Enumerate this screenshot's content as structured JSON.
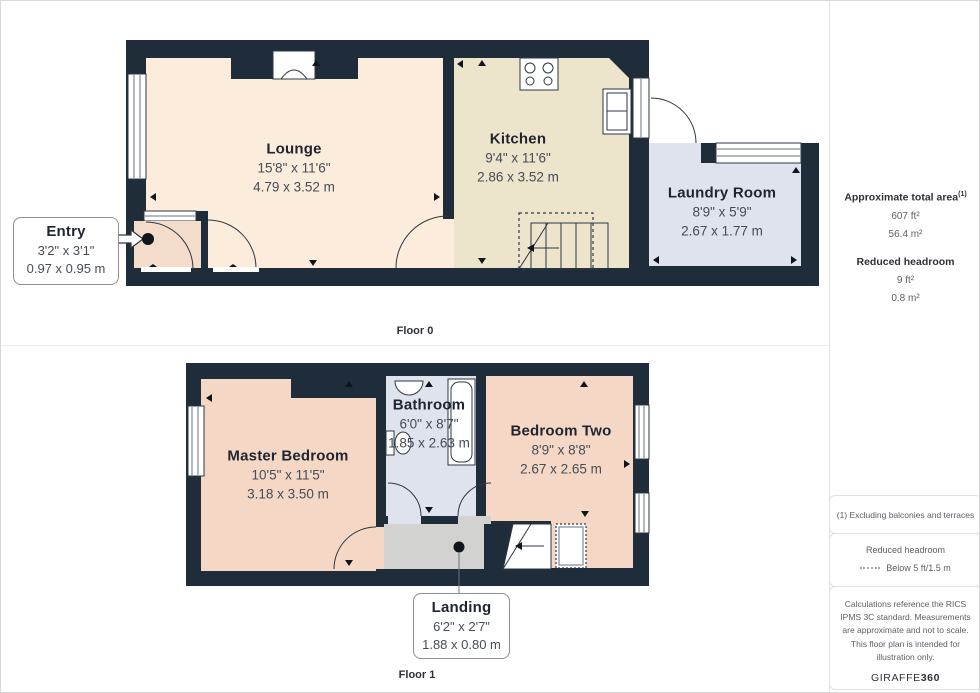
{
  "floors": [
    {
      "label": "Floor 0",
      "rooms": [
        {
          "name": "Lounge",
          "imperial": "15'8\" x 11'6\"",
          "metric": "4.79 x 3.52 m"
        },
        {
          "name": "Kitchen",
          "imperial": "9'4\" x 11'6\"",
          "metric": "2.86 x 3.52 m"
        },
        {
          "name": "Laundry Room",
          "imperial": "8'9\" x 5'9\"",
          "metric": "2.67 x 1.77 m"
        }
      ],
      "callouts": [
        {
          "name": "Entry",
          "imperial": "3'2\" x 3'1\"",
          "metric": "0.97 x 0.95 m"
        }
      ]
    },
    {
      "label": "Floor 1",
      "rooms": [
        {
          "name": "Master Bedroom",
          "imperial": "10'5\" x 11'5\"",
          "metric": "3.18 x 3.50 m"
        },
        {
          "name": "Bathroom",
          "imperial": "6'0\" x 8'7\"",
          "metric": "1.85 x 2.63 m"
        },
        {
          "name": "Bedroom Two",
          "imperial": "8'9\" x 8'8\"",
          "metric": "2.67 x 2.65 m"
        }
      ],
      "callouts": [
        {
          "name": "Landing",
          "imperial": "6'2\" x 2'7\"",
          "metric": "1.88 x 0.80 m"
        }
      ]
    }
  ],
  "sidebar": {
    "total_area_label": "Approximate total area",
    "total_area_sup": "(1)",
    "total_area_ft": "607 ft²",
    "total_area_m": "56.4 m²",
    "reduced_headroom_label": "Reduced headroom",
    "reduced_headroom_ft": "9 ft²",
    "reduced_headroom_m": "0.8 m²",
    "notes": {
      "exclusion": "(1) Excluding balconies and terraces",
      "headroom_title": "Reduced headroom",
      "headroom_legend": "Below 5 ft/1.5 m",
      "disclaimer": "Calculations reference the RICS IPMS 3C standard. Measurements are approximate and not to scale. This floor plan is intended for illustration only.",
      "brand": "GIRAFFE",
      "brand_bold": "360"
    }
  },
  "colors": {
    "wall": "#1f2c3a",
    "lounge": "#fcecdc",
    "kitchen": "#ece4cb",
    "laundry": "#dfe3ee",
    "bathroom": "#dfe3ee",
    "bedroom": "#f4d8c5",
    "entry": "#f3dcca",
    "landing": "#d2d2d0"
  }
}
